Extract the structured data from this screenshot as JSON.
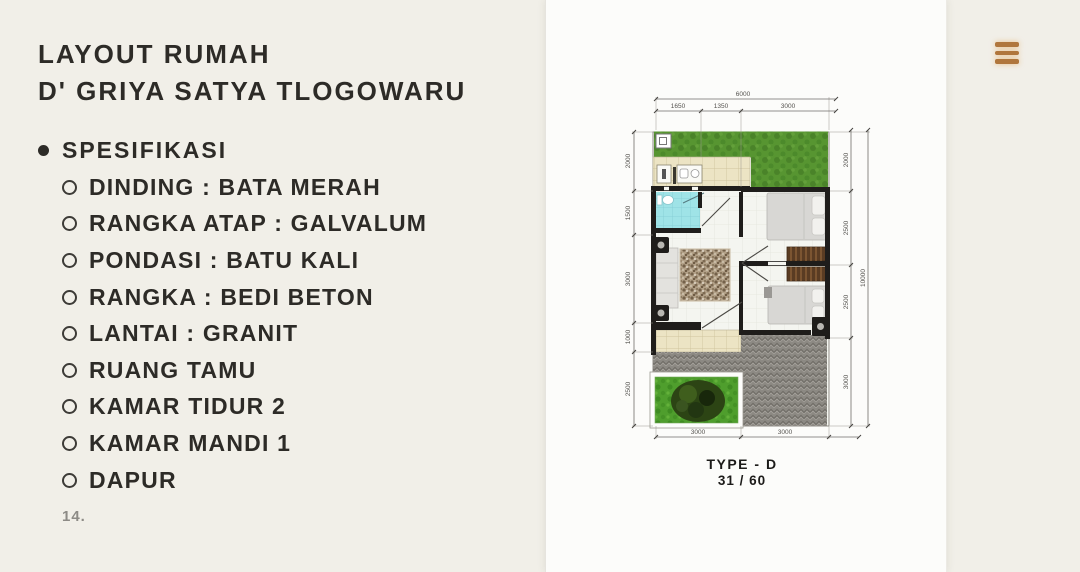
{
  "slide": {
    "title_line1": "LAYOUT RUMAH",
    "title_line2": "D' GRIYA SATYA TLOGOWARU",
    "spec_heading": "SPESIFIKASI",
    "spec_items": [
      "DINDING : BATA MERAH",
      "RANGKA ATAP : GALVALUM",
      "PONDASI : BATU KALI",
      "RANGKA : BEDI BETON",
      "LANTAI : GRANIT",
      "RUANG TAMU",
      "KAMAR TIDUR 2",
      "KAMAR MANDI 1",
      "DAPUR"
    ],
    "page_number": "14."
  },
  "floorplan": {
    "type_label": "TYPE - D",
    "size_label": "31 / 60",
    "dims": {
      "top_total": "6000",
      "top_segments": [
        "1650",
        "1350",
        "3000"
      ],
      "left_segments": [
        "2000",
        "1500",
        "3000",
        "1000",
        "2500"
      ],
      "right_segments": [
        "2000",
        "2500",
        "2500",
        "3000"
      ],
      "right_total": "10000",
      "bottom_segments": [
        "3000",
        "3000"
      ]
    }
  },
  "menu": {
    "hamburger_color": "#b0763c"
  },
  "colors": {
    "background": "#f1efe8",
    "card": "#fcfcfa",
    "text": "#2d2b27",
    "muted": "#8d8b86",
    "grass": "#579531",
    "garden_grass": "#4f9e2d",
    "paving": "#8c8983",
    "bathroom": "#9fe3e7",
    "kitchen_tile": "#ece4c4",
    "wardrobe": "#5a3c23",
    "wall": "#1f1d1b"
  }
}
